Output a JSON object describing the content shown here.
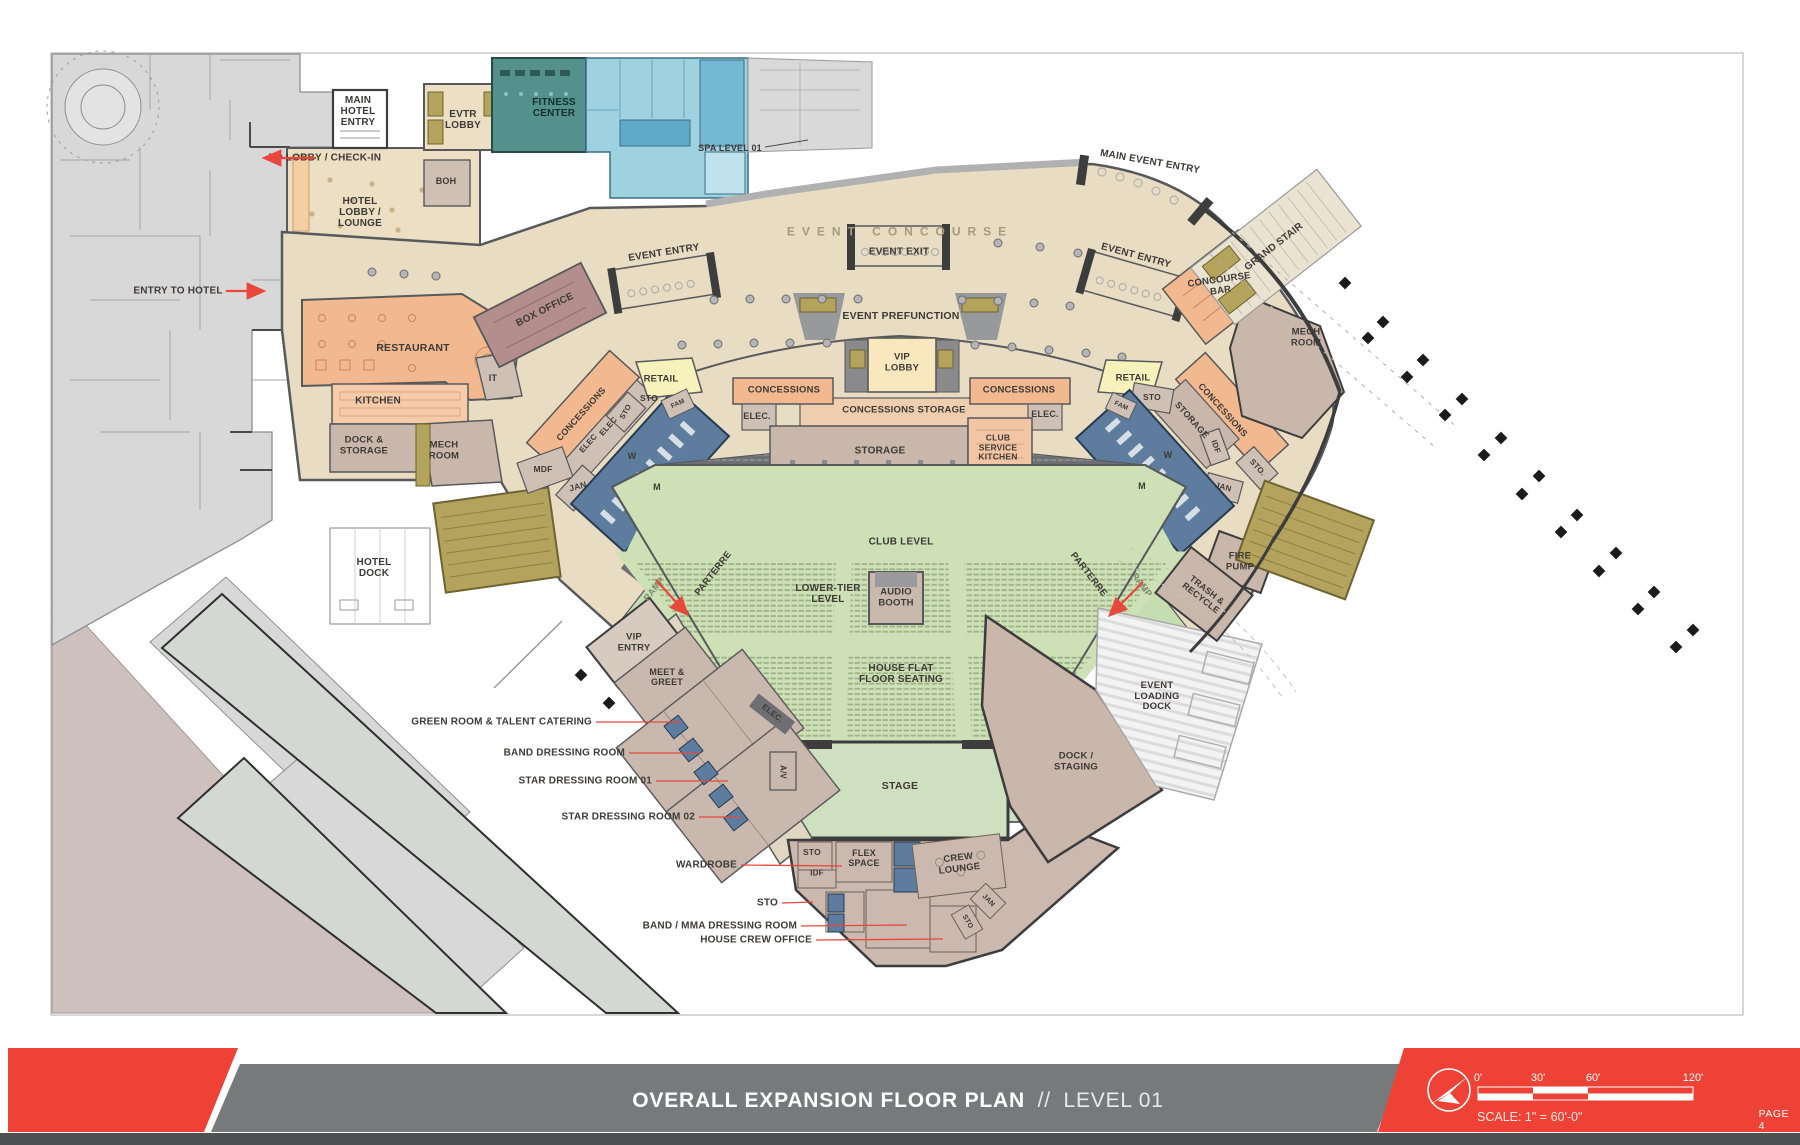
{
  "footer": {
    "title_bold": "OVERALL EXPANSION FLOOR PLAN",
    "title_divider": "//",
    "title_light": "LEVEL 01",
    "page_label": "PAGE 4",
    "scale_label": "SCALE: 1\" = 60'-0\"",
    "scale_ticks": [
      "0'",
      "30'",
      "60'",
      "120'"
    ],
    "accent_red": "#ee4236",
    "bar_gray": "#77797b",
    "strip_dark": "#4f5052"
  },
  "plan": {
    "colors": {
      "concourse_tan": "#e8dcc2",
      "seating_green": "#cde0b6",
      "stage_green": "#cfe0c1",
      "concessions_salmon": "#f2b890",
      "boh_taupe": "#c9b7ac",
      "restroom_blue": "#5e7c9e",
      "retail_yellow": "#f7f1bb",
      "vip_cream": "#f9e8bd",
      "fitness_teal": "#54908c",
      "spa_blue": "#9ed2e1",
      "stair_khaki": "#b3a35c",
      "existing_gray": "#d8d8d8",
      "box_office_mauve": "#b48e8d",
      "club_dark": "#6e6f72",
      "wall_dark": "#58595b",
      "accent_red": "#e8473b"
    },
    "labels": [
      {
        "text": "MAIN\nHOTEL\nENTRY",
        "x": 358,
        "y": 112,
        "fs": 10
      },
      {
        "text": "TO LOBBY / CHECK-IN",
        "x": 325,
        "y": 158,
        "fs": 10
      },
      {
        "text": "ENTRY TO HOTEL",
        "x": 178,
        "y": 291,
        "fs": 10
      },
      {
        "text": "EVTR\nLOBBY",
        "x": 463,
        "y": 120,
        "fs": 10
      },
      {
        "text": "FITNESS\nCENTER",
        "x": 554,
        "y": 108,
        "fs": 10,
        "color": "#11302e"
      },
      {
        "text": "SPA LEVEL 01",
        "x": 730,
        "y": 148,
        "fs": 9
      },
      {
        "text": "BOH",
        "x": 446,
        "y": 181,
        "fs": 9
      },
      {
        "text": "HOTEL\nLOBBY /\nLOUNGE",
        "x": 360,
        "y": 213,
        "fs": 10
      },
      {
        "text": "EVENT CONCOURSE",
        "x": 900,
        "y": 232,
        "fs": 12,
        "ls": 7,
        "color": "#a89b7c"
      },
      {
        "text": "EVENT ENTRY",
        "x": 664,
        "y": 253,
        "fs": 10,
        "rot": -9
      },
      {
        "text": "EVENT EXIT",
        "x": 899,
        "y": 252,
        "fs": 10
      },
      {
        "text": "EVENT ENTRY",
        "x": 1136,
        "y": 256,
        "fs": 10,
        "rot": 15
      },
      {
        "text": "MAIN EVENT ENTRY",
        "x": 1150,
        "y": 162,
        "fs": 10,
        "rot": 10
      },
      {
        "text": "GRAND STAIR",
        "x": 1274,
        "y": 247,
        "fs": 10,
        "rot": -38
      },
      {
        "text": "CONCOURSE\nBAR",
        "x": 1220,
        "y": 286,
        "fs": 9.5,
        "rot": -8
      },
      {
        "text": "MECH\nROOM",
        "x": 1306,
        "y": 338,
        "fs": 9.5
      },
      {
        "text": "EVENT PREFUNCTION",
        "x": 901,
        "y": 317,
        "fs": 10.5
      },
      {
        "text": "VIP\nLOBBY",
        "x": 902,
        "y": 363,
        "fs": 9.5
      },
      {
        "text": "RETAIL",
        "x": 661,
        "y": 380,
        "fs": 9.5
      },
      {
        "text": "STO",
        "x": 649,
        "y": 399,
        "fs": 8.5
      },
      {
        "text": "CONCESSIONS",
        "x": 784,
        "y": 391,
        "fs": 9.5
      },
      {
        "text": "ELEC.",
        "x": 757,
        "y": 416,
        "fs": 9
      },
      {
        "text": "CONCESSIONS STORAGE",
        "x": 904,
        "y": 411,
        "fs": 9.5
      },
      {
        "text": "STORAGE",
        "x": 880,
        "y": 451,
        "fs": 10
      },
      {
        "text": "CLUB\nSERVICE\nKITCHEN",
        "x": 998,
        "y": 448,
        "fs": 8.5
      },
      {
        "text": "CONCESSIONS",
        "x": 1019,
        "y": 391,
        "fs": 9.5
      },
      {
        "text": "ELEC.",
        "x": 1045,
        "y": 414,
        "fs": 9
      },
      {
        "text": "RETAIL",
        "x": 1133,
        "y": 379,
        "fs": 9.5
      },
      {
        "text": "STO",
        "x": 1152,
        "y": 398,
        "fs": 8.5
      },
      {
        "text": "FAM",
        "x": 1121,
        "y": 406,
        "fs": 6.5,
        "rot": 25
      },
      {
        "text": "BOX OFFICE",
        "x": 545,
        "y": 310,
        "fs": 10,
        "rot": -27
      },
      {
        "text": "IT",
        "x": 493,
        "y": 378,
        "fs": 9
      },
      {
        "text": "RESTAURANT",
        "x": 413,
        "y": 349,
        "fs": 10.5
      },
      {
        "text": "KITCHEN",
        "x": 378,
        "y": 401,
        "fs": 10
      },
      {
        "text": "DOCK &\nSTORAGE",
        "x": 364,
        "y": 446,
        "fs": 9.5
      },
      {
        "text": "MECH\nROOM",
        "x": 444,
        "y": 451,
        "fs": 9.5
      },
      {
        "text": "HOTEL\nDOCK",
        "x": 374,
        "y": 568,
        "fs": 10
      },
      {
        "text": "CONCESSIONS",
        "x": 581,
        "y": 414,
        "fs": 9,
        "rot": -48
      },
      {
        "text": "ELEC",
        "x": 609,
        "y": 427,
        "fs": 8,
        "rot": -48
      },
      {
        "text": "ELEC",
        "x": 589,
        "y": 444,
        "fs": 8,
        "rot": -48
      },
      {
        "text": "STO",
        "x": 626,
        "y": 412,
        "fs": 7.5,
        "rot": -60
      },
      {
        "text": "FAM",
        "x": 678,
        "y": 404,
        "fs": 6.5,
        "rot": -25
      },
      {
        "text": "W",
        "x": 632,
        "y": 456,
        "fs": 9
      },
      {
        "text": "M",
        "x": 657,
        "y": 487,
        "fs": 9
      },
      {
        "text": "MDF",
        "x": 543,
        "y": 470,
        "fs": 8.5
      },
      {
        "text": "JAN",
        "x": 578,
        "y": 487,
        "fs": 8.5,
        "rot": -15
      },
      {
        "text": "CONCESSIONS",
        "x": 1223,
        "y": 410,
        "fs": 9,
        "rot": 48
      },
      {
        "text": "STORAGE",
        "x": 1192,
        "y": 420,
        "fs": 9,
        "rot": 48
      },
      {
        "text": "IDF",
        "x": 1215,
        "y": 447,
        "fs": 8,
        "rot": 70
      },
      {
        "text": "STO.",
        "x": 1257,
        "y": 468,
        "fs": 8,
        "rot": 48
      },
      {
        "text": "JAN",
        "x": 1223,
        "y": 488,
        "fs": 8,
        "rot": 15
      },
      {
        "text": "W",
        "x": 1168,
        "y": 455,
        "fs": 9
      },
      {
        "text": "M",
        "x": 1142,
        "y": 486,
        "fs": 9
      },
      {
        "text": "FIRE\nPUMP",
        "x": 1240,
        "y": 562,
        "fs": 9.5
      },
      {
        "text": "TRASH &\nRECYCLE",
        "x": 1204,
        "y": 594,
        "fs": 9,
        "rot": 38
      },
      {
        "text": "EVENT\nLOADING\nDOCK",
        "x": 1157,
        "y": 697,
        "fs": 9.5
      },
      {
        "text": "DOCK /\nSTAGING",
        "x": 1076,
        "y": 762,
        "fs": 9.5
      },
      {
        "text": "CLUB LEVEL",
        "x": 901,
        "y": 542,
        "fs": 10
      },
      {
        "text": "PARTERRE",
        "x": 714,
        "y": 574,
        "fs": 9.5,
        "rot": -52
      },
      {
        "text": "PARTERRE",
        "x": 1088,
        "y": 575,
        "fs": 9.5,
        "rot": 52
      },
      {
        "text": "RAMP",
        "x": 654,
        "y": 589,
        "fs": 9,
        "rot": -52,
        "color": "#7b8a6e"
      },
      {
        "text": "RAMP",
        "x": 1142,
        "y": 585,
        "fs": 9,
        "rot": 52,
        "color": "#7b8a6e"
      },
      {
        "text": "LOWER-TIER\nLEVEL",
        "x": 828,
        "y": 594,
        "fs": 10
      },
      {
        "text": "AUDIO\nBOOTH",
        "x": 896,
        "y": 598,
        "fs": 9.5
      },
      {
        "text": "HOUSE FLAT\nFLOOR SEATING",
        "x": 901,
        "y": 674,
        "fs": 10
      },
      {
        "text": "STAGE",
        "x": 900,
        "y": 787,
        "fs": 10.5
      },
      {
        "text": "VIP\nENTRY",
        "x": 634,
        "y": 643,
        "fs": 9.5
      },
      {
        "text": "MEET &\nGREET",
        "x": 667,
        "y": 677,
        "fs": 9
      },
      {
        "text": "ELEC.",
        "x": 772,
        "y": 714,
        "fs": 8,
        "rot": 38
      },
      {
        "text": "A/V",
        "x": 782,
        "y": 772,
        "fs": 8,
        "rot": 90
      },
      {
        "text": "STO",
        "x": 812,
        "y": 853,
        "fs": 8.5
      },
      {
        "text": "FLEX\nSPACE",
        "x": 864,
        "y": 858,
        "fs": 9
      },
      {
        "text": "IDF",
        "x": 817,
        "y": 874,
        "fs": 8
      },
      {
        "text": "CREW\nLOUNGE",
        "x": 959,
        "y": 864,
        "fs": 9.5,
        "rot": -7
      },
      {
        "text": "JAN",
        "x": 988,
        "y": 901,
        "fs": 7,
        "rot": 45
      },
      {
        "text": "STO",
        "x": 967,
        "y": 922,
        "fs": 7,
        "rot": 60
      }
    ],
    "callouts": [
      {
        "text": "GREEN ROOM & TALENT CATERING",
        "x": 592,
        "y": 722,
        "tx": 680,
        "ty": 722
      },
      {
        "text": "BAND DRESSING ROOM",
        "x": 625,
        "y": 753,
        "tx": 700,
        "ty": 753
      },
      {
        "text": "STAR DRESSING ROOM 01",
        "x": 652,
        "y": 781,
        "tx": 728,
        "ty": 781
      },
      {
        "text": "STAR DRESSING ROOM 02",
        "x": 695,
        "y": 817,
        "tx": 740,
        "ty": 817
      },
      {
        "text": "WARDROBE",
        "x": 737,
        "y": 865,
        "tx": 842,
        "ty": 866
      },
      {
        "text": "STO",
        "x": 778,
        "y": 903,
        "tx": 813,
        "ty": 902
      },
      {
        "text": "BAND / MMA DRESSING ROOM",
        "x": 797,
        "y": 926,
        "tx": 907,
        "ty": 925
      },
      {
        "text": "HOUSE CREW OFFICE",
        "x": 812,
        "y": 940,
        "tx": 943,
        "ty": 939
      }
    ],
    "arrows": [
      {
        "x1": 316,
        "y1": 158,
        "x2": 266,
        "y2": 158
      },
      {
        "x1": 226,
        "y1": 291,
        "x2": 262,
        "y2": 291
      },
      {
        "x1": 656,
        "y1": 580,
        "x2": 686,
        "y2": 613
      },
      {
        "x1": 1143,
        "y1": 582,
        "x2": 1111,
        "y2": 614
      }
    ],
    "site_markers": [
      [
        1345,
        283
      ],
      [
        1368,
        338
      ],
      [
        1383,
        322
      ],
      [
        1407,
        377
      ],
      [
        1423,
        360
      ],
      [
        1445,
        415
      ],
      [
        1462,
        399
      ],
      [
        1484,
        455
      ],
      [
        1501,
        438
      ],
      [
        1522,
        494
      ],
      [
        1539,
        476
      ],
      [
        1561,
        532
      ],
      [
        1577,
        515
      ],
      [
        1599,
        571
      ],
      [
        1616,
        553
      ],
      [
        1638,
        609
      ],
      [
        1654,
        592
      ],
      [
        1676,
        647
      ],
      [
        1693,
        630
      ],
      [
        581,
        675
      ],
      [
        609,
        703
      ]
    ]
  }
}
